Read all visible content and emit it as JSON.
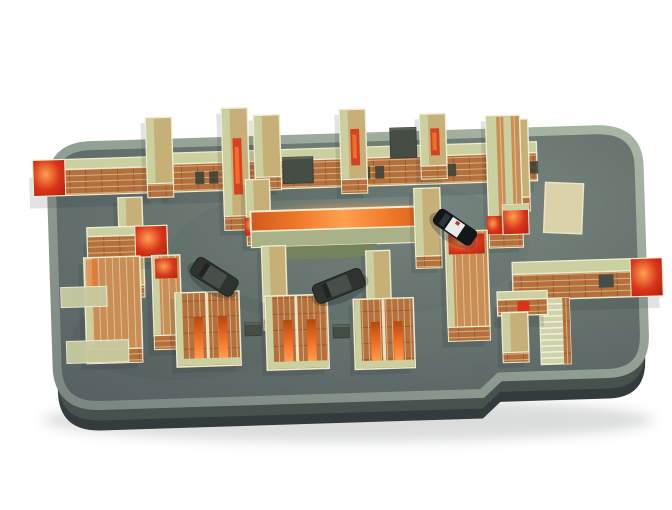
{
  "meta": {
    "scene_description": "3D isometric render of a maze game level: brick walls with khaki tops and glowing red-orange accents on a grey rounded platform, with a black-and-white police car and two dark sedans on the floor",
    "canvas": {
      "width": 672,
      "height": 510
    }
  },
  "palette": {
    "background": "#ffffff",
    "floor_light": "#7d8a84",
    "floor_mid": "#68756f",
    "floor_dark": "#535f62",
    "rim_dark": "#7a8681",
    "rim_light": "#a8b7a4",
    "side": "#49514f",
    "side_dark": "#343b3c",
    "ground_shadow": "#9aa0a0",
    "wall_top": "#cbd0a0",
    "v_top": "#c6b077",
    "wall_edge": "#eeeccf",
    "brick": "#b4713d",
    "brick_dark": "#97582c",
    "brick_light": "#c88e55",
    "mortar": "#d8ae7e",
    "mortar_light": "#e2c091",
    "accent_red": "#d93418",
    "accent_orange": "#f26d26",
    "glow_edge": "#cf5a20",
    "glow_mid": "#f07828",
    "glow_hot": "#ffa050",
    "glow_front": "#a9b187",
    "green_base": "#74825f",
    "ladder": "#ced3ac",
    "rung": "#f2f4dc",
    "ramp": "#dbd2ab",
    "ramp_edge": "#ece5c2",
    "dark_box": "#464d45",
    "dark_box_edge": "#39403a",
    "window_dark": "#3a4038",
    "pale": "#c7cba1",
    "sedan_body": "#2e332f",
    "sedan_roof": "#474f48",
    "sedan_glass": "#20261f",
    "police_body": "#141719",
    "police_white": "#e8ebe9",
    "police_glass": "#2b3438",
    "police_light": "#c23322",
    "shadow": "#1f2a30"
  },
  "scene": {
    "rotation_deg": -1.8,
    "rotation_center": [
      336,
      263
    ],
    "platform": {
      "top_path": "M 94,138 L 600,138 Q 642,138 642,176 L 642,344 Q 642,382 604,382 L 496,382 L 478,398 L 96,398 Q 54,398 54,358 L 54,178 Q 54,138 94,138 Z",
      "side_offset": 15,
      "side2_offset": 25,
      "rim_width": 9,
      "ground_shadow": {
        "cx": 348,
        "cy": 420,
        "rx": 305,
        "ry": 22,
        "opacity": 0.35
      }
    },
    "walls": [
      {
        "kind": "h",
        "x": 36,
        "y": 151,
        "w": 120,
        "top": 10,
        "front": 26,
        "red": "left"
      },
      {
        "kind": "h",
        "x": 168,
        "y": 148,
        "w": 372,
        "top": 11,
        "front": 28,
        "windows": [
          30,
          44,
          120,
          134,
          196,
          210,
          268,
          282,
          350,
          364
        ]
      },
      {
        "kind": "v",
        "x": 150,
        "y": 112,
        "w": 26,
        "len": 66,
        "front": 14
      },
      {
        "kind": "v",
        "x": 226,
        "y": 105,
        "w": 26,
        "len": 108,
        "front": 14,
        "streak": true
      },
      {
        "kind": "v",
        "x": 258,
        "y": 113,
        "w": 26,
        "len": 62,
        "front": 13
      },
      {
        "kind": "v",
        "x": 344,
        "y": 110,
        "w": 26,
        "len": 70,
        "front": 14,
        "streak": true
      },
      {
        "kind": "v",
        "x": 424,
        "y": 117,
        "w": 26,
        "len": 52,
        "front": 13,
        "streak": true
      },
      {
        "kind": "v",
        "x": 504,
        "y": 125,
        "w": 28,
        "len": 78,
        "front": 14,
        "streak": true
      },
      {
        "kind": "dark",
        "x": 286,
        "y": 156,
        "w": 30,
        "h": 26
      },
      {
        "kind": "dark",
        "x": 394,
        "y": 130,
        "w": 26,
        "h": 30
      },
      {
        "kind": "v",
        "x": 120,
        "y": 191,
        "w": 24,
        "len": 88,
        "front": 12
      },
      {
        "kind": "h",
        "x": 88,
        "y": 220,
        "w": 80,
        "top": 9,
        "front": 22,
        "red": "right"
      },
      {
        "kind": "slab",
        "x": 84,
        "y": 250,
        "w": 56,
        "len": 92,
        "front": 14,
        "orange_edge": true
      },
      {
        "kind": "pale",
        "x": 60,
        "y": 279,
        "w": 46,
        "h": 20
      },
      {
        "kind": "pale",
        "x": 64,
        "y": 333,
        "w": 62,
        "h": 22
      },
      {
        "kind": "slab",
        "x": 152,
        "y": 250,
        "w": 28,
        "len": 80,
        "front": 14,
        "red_top": true
      },
      {
        "kind": "v",
        "x": 248,
        "y": 177,
        "w": 24,
        "len": 54,
        "front": 12,
        "red_bottom": true
      },
      {
        "kind": "glow",
        "x": 252,
        "y": 209,
        "w": 186,
        "top": 20,
        "front": 16
      },
      {
        "kind": "v",
        "x": 416,
        "y": 191,
        "w": 26,
        "len": 68,
        "front": 12
      },
      {
        "kind": "vd",
        "x": 490,
        "y": 121,
        "w": 34,
        "len": 116,
        "front": 16,
        "red_bottom": true
      },
      {
        "kind": "ramp",
        "x": 548,
        "y": 189,
        "w": 38,
        "h": 50
      },
      {
        "kind": "redblock",
        "x": 504,
        "y": 210,
        "w": 26,
        "h": 30
      },
      {
        "kind": "v",
        "x": 262,
        "y": 244,
        "w": 24,
        "len": 72,
        "front": 12
      },
      {
        "kind": "v",
        "x": 366,
        "y": 252,
        "w": 24,
        "len": 64,
        "front": 12
      },
      {
        "kind": "slab",
        "x": 446,
        "y": 235,
        "w": 42,
        "len": 96,
        "front": 14,
        "red_top": true
      },
      {
        "kind": "h",
        "x": 512,
        "y": 268,
        "w": 150,
        "top": 12,
        "front": 26,
        "red": "right",
        "darks": [
          86
        ]
      },
      {
        "kind": "ladder",
        "x": 538,
        "y": 305,
        "w": 30,
        "len": 66
      },
      {
        "kind": "h",
        "x": 496,
        "y": 297,
        "w": 50,
        "top": 8,
        "front": 16,
        "red_dot": true
      },
      {
        "kind": "v",
        "x": 500,
        "y": 318,
        "w": 26,
        "len": 40,
        "front": 10
      },
      {
        "kind": "block",
        "x": 174,
        "y": 288,
        "w": 64,
        "len": 74
      },
      {
        "kind": "block",
        "x": 264,
        "y": 294,
        "w": 62,
        "len": 74
      },
      {
        "kind": "block",
        "x": 352,
        "y": 300,
        "w": 60,
        "len": 70
      },
      {
        "kind": "dark",
        "x": 243,
        "y": 320,
        "w": 16,
        "h": 13
      },
      {
        "kind": "dark",
        "x": 331,
        "y": 325,
        "w": 16,
        "h": 13
      }
    ],
    "cars": [
      {
        "type": "sedan",
        "cx": 214,
        "cy": 273,
        "rot": 34,
        "len": 48,
        "wid": 20
      },
      {
        "type": "sedan",
        "cx": 338,
        "cy": 286,
        "rot": -20,
        "len": 52,
        "wid": 20
      },
      {
        "type": "police",
        "cx": 456,
        "cy": 231,
        "rot": 36,
        "len": 46,
        "wid": 18
      }
    ]
  }
}
